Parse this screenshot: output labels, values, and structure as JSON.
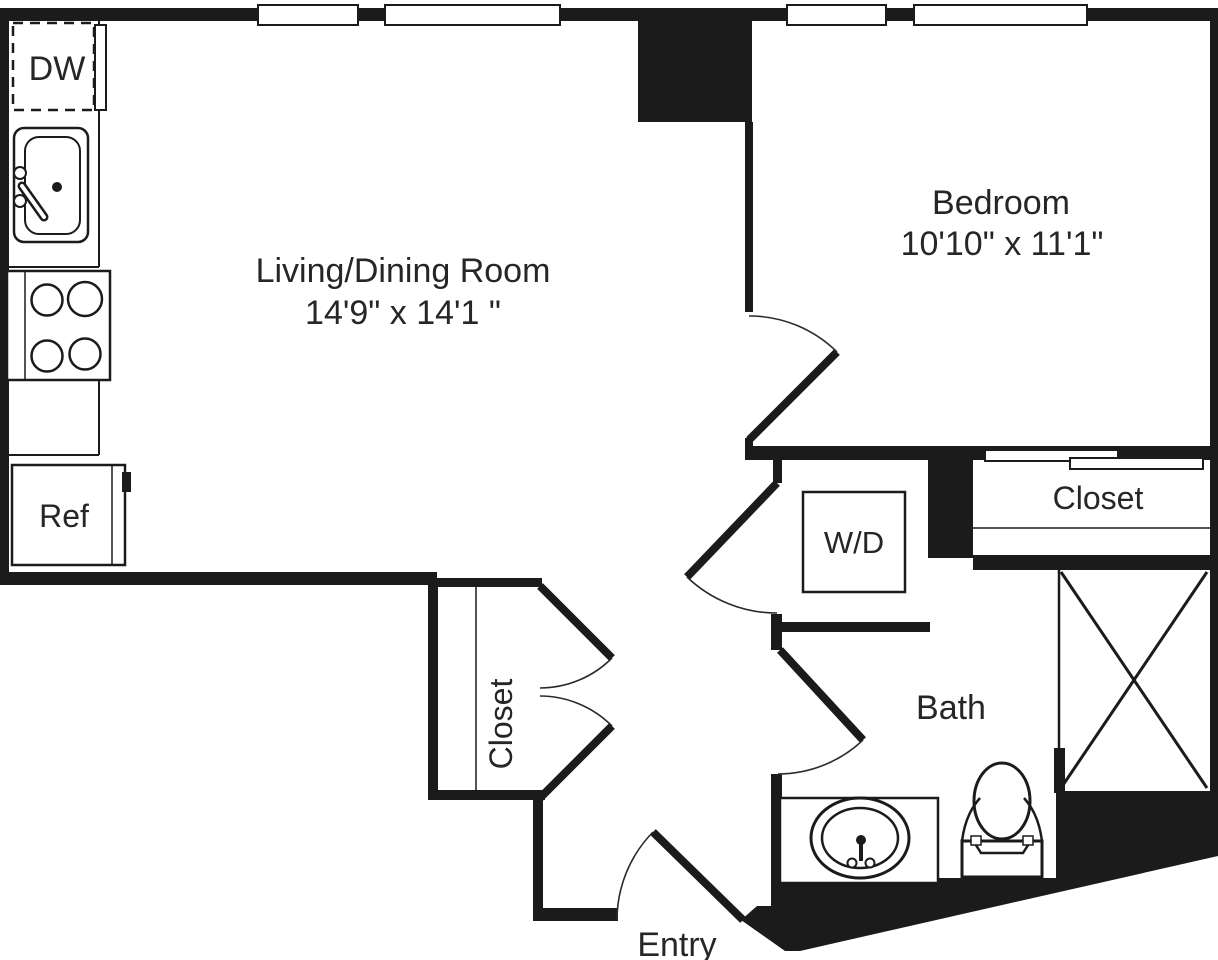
{
  "floor_plan": {
    "title": "One-bedroom apartment floor plan",
    "colors": {
      "wall": "#1b1b1b",
      "background": "#ffffff",
      "text": "#262626"
    },
    "rooms": {
      "living_dining": {
        "name": "Living/Dining Room",
        "dimensions": "14'9\" x 14'1 \""
      },
      "bedroom": {
        "name": "Bedroom",
        "dimensions": "10'10\" x 11'1\""
      },
      "bath": {
        "name": "Bath"
      },
      "entry": {
        "name": "Entry"
      },
      "bedroom_closet": {
        "name": "Closet"
      },
      "hall_closet": {
        "name": "Closet"
      }
    },
    "fixtures": {
      "dishwasher": "DW",
      "refrigerator": "Ref",
      "washer_dryer": "W/D"
    }
  }
}
